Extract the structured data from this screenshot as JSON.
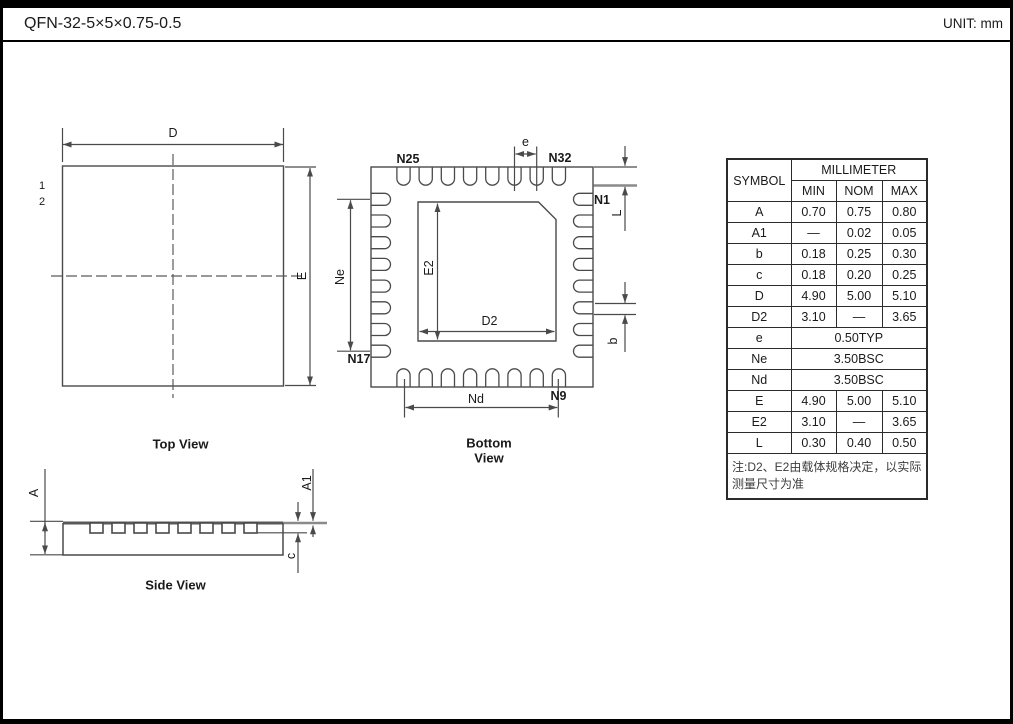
{
  "header": {
    "title": "QFN-32-5×5×0.75-0.5",
    "unit_label": "UNIT: mm"
  },
  "top_view": {
    "caption": "Top View",
    "dim_d": "D",
    "dim_e": "E",
    "pin_marker_1": "1",
    "pin_marker_2": "2"
  },
  "bottom_view": {
    "caption_line1": "Bottom",
    "caption_line2": "View",
    "dim_e": "e",
    "dim_l": "L",
    "dim_b": "b",
    "dim_ne": "Ne",
    "dim_e2": "E2",
    "dim_d2": "D2",
    "dim_nd": "Nd",
    "pin_n1": "N1",
    "pin_n9": "N9",
    "pin_n17": "N17",
    "pin_n25": "N25",
    "pin_n32": "N32"
  },
  "side_view": {
    "caption": "Side View",
    "dim_a": "A",
    "dim_a1": "A1",
    "dim_c": "c"
  },
  "table": {
    "symbol_header": "SYMBOL",
    "group_header": "MILLIMETER",
    "columns": [
      "MIN",
      "NOM",
      "MAX"
    ],
    "rows": [
      {
        "symbol": "A",
        "min": "0.70",
        "nom": "0.75",
        "max": "0.80"
      },
      {
        "symbol": "A1",
        "min": "—",
        "nom": "0.02",
        "max": "0.05"
      },
      {
        "symbol": "b",
        "min": "0.18",
        "nom": "0.25",
        "max": "0.30"
      },
      {
        "symbol": "c",
        "min": "0.18",
        "nom": "0.20",
        "max": "0.25"
      },
      {
        "symbol": "D",
        "min": "4.90",
        "nom": "5.00",
        "max": "5.10"
      },
      {
        "symbol": "D2",
        "min": "3.10",
        "nom": "—",
        "max": "3.65"
      },
      {
        "symbol": "e",
        "span": "0.50TYP"
      },
      {
        "symbol": "Ne",
        "span": "3.50BSC"
      },
      {
        "symbol": "Nd",
        "span": "3.50BSC"
      },
      {
        "symbol": "E",
        "min": "4.90",
        "nom": "5.00",
        "max": "5.10"
      },
      {
        "symbol": "E2",
        "min": "3.10",
        "nom": "—",
        "max": "3.65"
      },
      {
        "symbol": "L",
        "min": "0.30",
        "nom": "0.40",
        "max": "0.50"
      }
    ],
    "note": "注:D2、E2由载体规格决定，以实际测量尺寸为准"
  }
}
